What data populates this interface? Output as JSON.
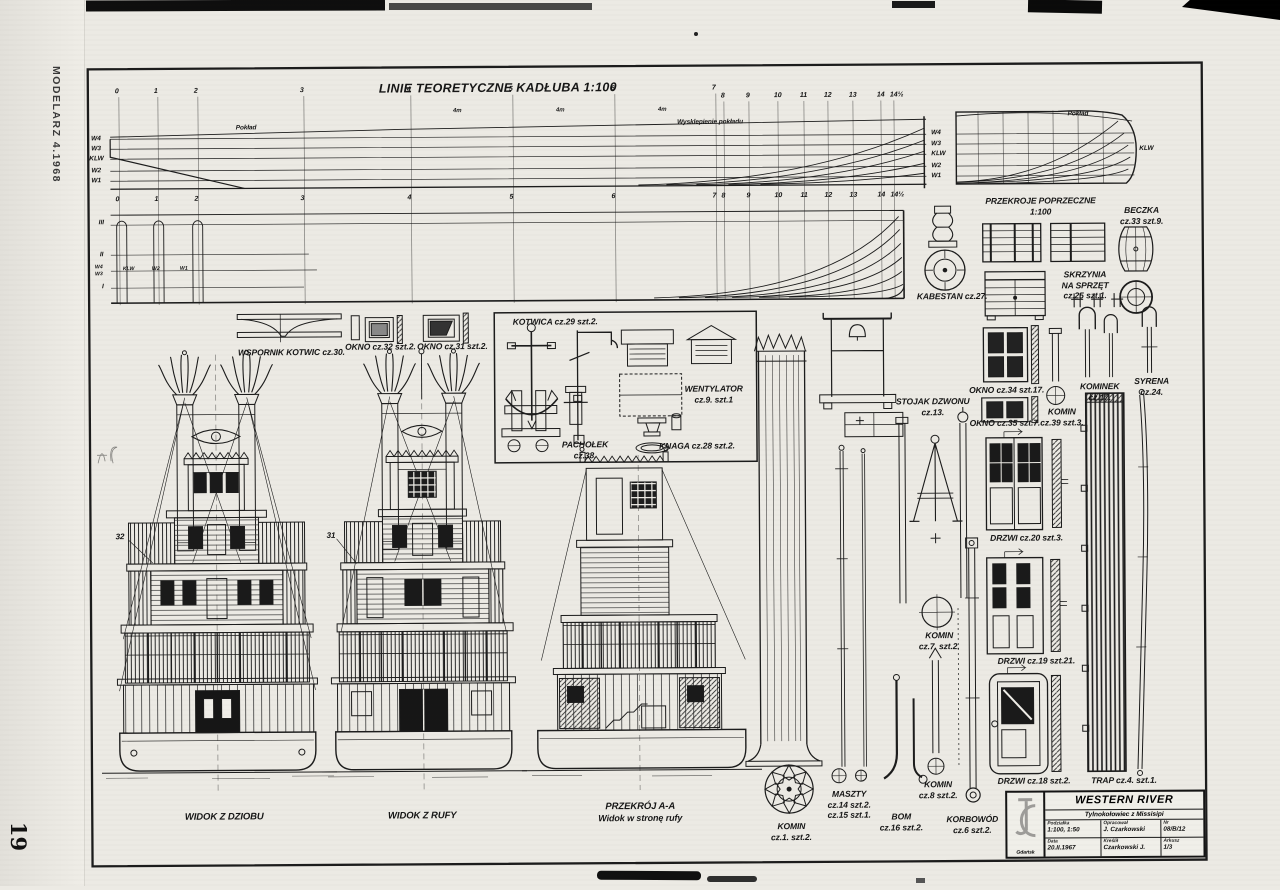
{
  "page": {
    "magazine": "MODELARZ 4.1968",
    "page_number": "19"
  },
  "sheet": {
    "title": "LINIE TEORETYCZNE KADŁUBA 1:100",
    "cross_sections_line1": "PRZEKROJE POPRZECZNE",
    "cross_sections_line2": "1:100"
  },
  "hull_plan": {
    "deck_label_left": "Pokład",
    "deck_camber_label": "Wysklepienie pokładu",
    "deck_label_body": "Pokład",
    "klw_body": "KLW",
    "waterlines_left": [
      "W4",
      "W3",
      "KLW",
      "W2",
      "W1"
    ],
    "waterlines_right": [
      "W4",
      "W3",
      "KLW",
      "W2",
      "W1"
    ],
    "profile_left": [
      "III",
      "II",
      "I"
    ],
    "profile_small": [
      "W4",
      "W3"
    ],
    "profile_mid": [
      "KLW",
      "W2",
      "W1"
    ],
    "stations_fore": [
      "0",
      "1",
      "2",
      "3",
      "4",
      "5",
      "6",
      "7"
    ],
    "stations_aft": [
      "8",
      "9",
      "10",
      "11",
      "12",
      "13",
      "14",
      "14½"
    ],
    "dim": "4m"
  },
  "views": [
    {
      "caption": "WIDOK Z DZIOBU"
    },
    {
      "caption": "WIDOK Z RUFY"
    },
    {
      "caption": "PRZEKRÓJ A-A",
      "caption2": "Widok w stronę rufy"
    }
  ],
  "callouts": [
    "32",
    "31"
  ],
  "parts": [
    {
      "l1": "WSPORNIK KOTWIC cz.30."
    },
    {
      "l1": "OKNO cz.32 szt.2."
    },
    {
      "l1": "OKNO cz.31 szt.2."
    },
    {
      "l1": "KOTWICA cz.29 szt.2."
    },
    {
      "l1": "WENTYLATOR",
      "l2": "cz.9. szt.1"
    },
    {
      "l1": "PACHOŁEK",
      "l2": "cz.38."
    },
    {
      "l1": "KNAGA cz.28 szt.2."
    },
    {
      "l1": "KABESTAN cz.27."
    },
    {
      "l1": "BECZKA",
      "l2": "cz.33 szt.9."
    },
    {
      "l1": "SKRZYNIA",
      "l2": "NA SPRZĘT",
      "l3": "cz.25 szt.1."
    },
    {
      "l1": "STOJAK DZWONU",
      "l2": "cz.13."
    },
    {
      "l1": "OKNO cz.34 szt.17."
    },
    {
      "l1": "OKNO cz.35 szt.7."
    },
    {
      "l1": "KOMIN",
      "l2": "cz.39 szt.3."
    },
    {
      "l1": "KOMINEK",
      "l2": "cz.17."
    },
    {
      "l1": "SYRENA",
      "l2": "cz.24."
    },
    {
      "l1": "KOMIN",
      "l2": "cz.7. szt.2."
    },
    {
      "l1": "DRZWI cz.20 szt.3."
    },
    {
      "l1": "DRZWI cz.19 szt.21."
    },
    {
      "l1": "DRZWI cz.18 szt.2."
    },
    {
      "l1": "TRAP cz.4. szt.1."
    },
    {
      "l1": "KOMIN",
      "l2": "cz.1. szt.2."
    },
    {
      "l1": "MASZTY",
      "l2": "cz.14 szt.2.",
      "l3": "cz.15 szt.1."
    },
    {
      "l1": "BOM",
      "l2": "cz.16 szt.2."
    },
    {
      "l1": "KOMIN",
      "l2": "cz.8 szt.2."
    },
    {
      "l1": "KORBOWÓD",
      "l2": "cz.6 szt.2."
    }
  ],
  "title_block": {
    "logo_city": "Gdańsk",
    "title": "WESTERN RIVER",
    "subtitle": "Tylnokołowiec z Missisipi",
    "fields": [
      {
        "label": "Podziałka",
        "value": "1:100, 1:50"
      },
      {
        "label": "Opracował",
        "value": "J. Czarkowski"
      },
      {
        "label": "Nr",
        "value": "08/B/12"
      },
      {
        "label": "Data",
        "value": "20.II.1967"
      },
      {
        "label": "Kreślił",
        "value": "Czarkowski J."
      },
      {
        "label": "Arkusz",
        "value": "1/3"
      }
    ]
  }
}
